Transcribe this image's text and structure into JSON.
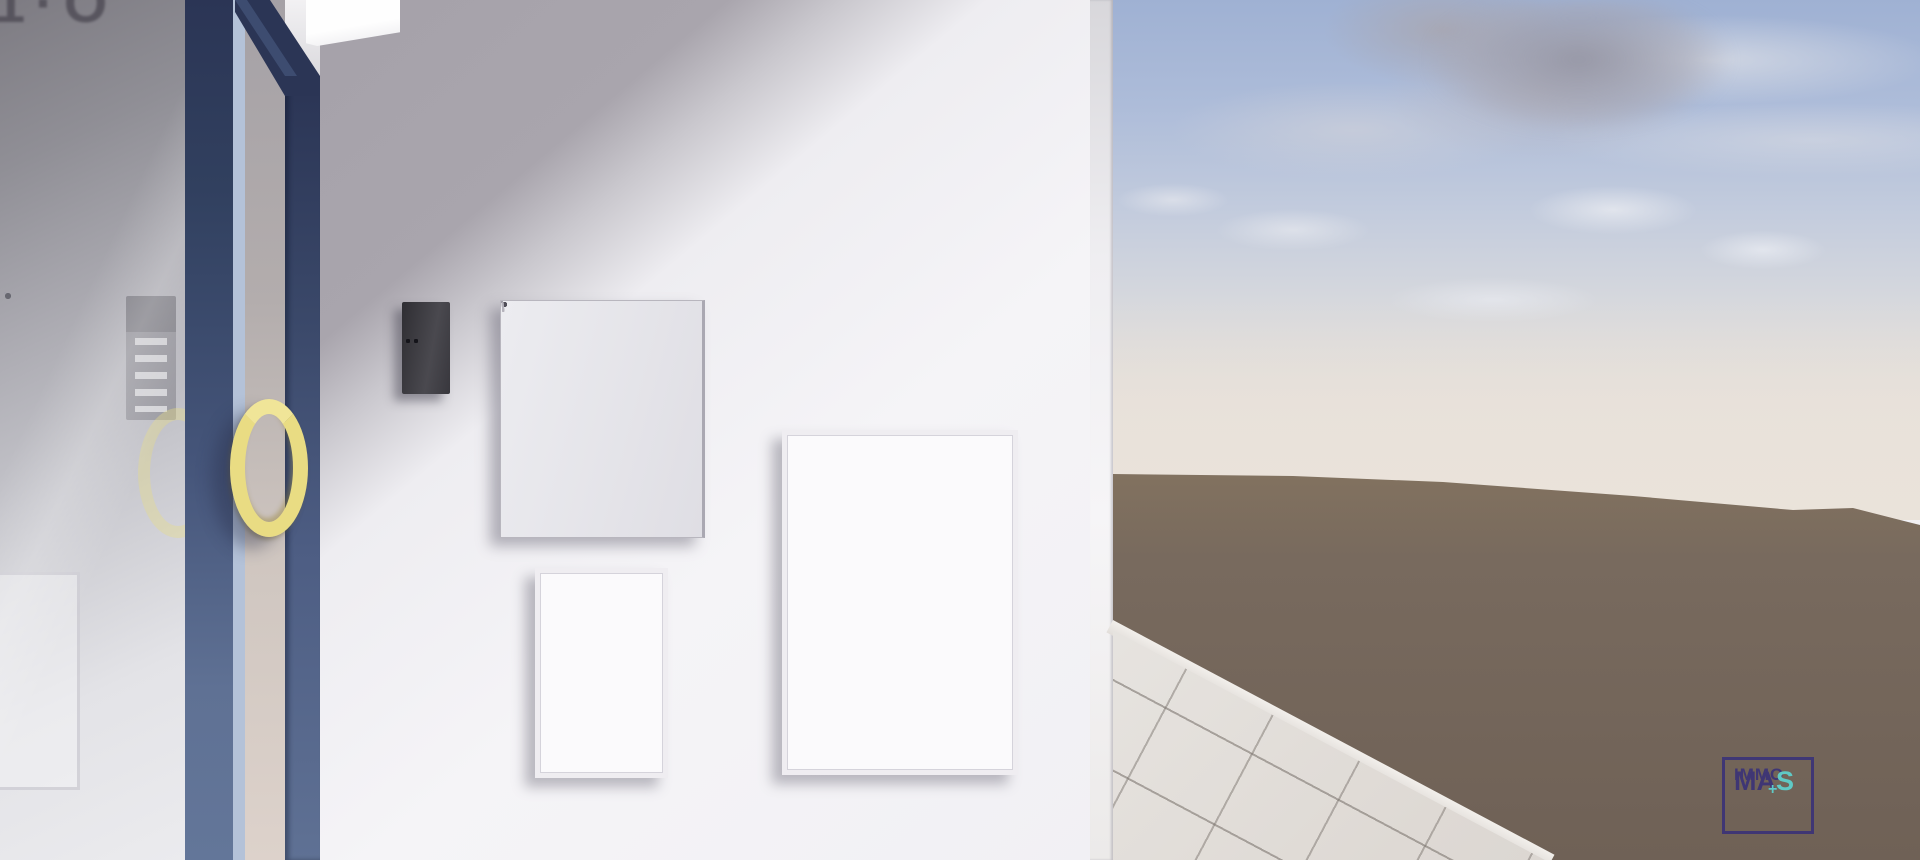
{
  "scene": {
    "glass_sign_partial_text": "1·O"
  },
  "logo": {
    "line1": "IMMO",
    "line2_prefix": "MA",
    "plus": "+",
    "line2_suffix": "S"
  },
  "mailboxes": {
    "columns": 2,
    "rows": 5
  },
  "intercom": {
    "label_slots": 5
  },
  "reflection": {
    "mailbox_rows": 5
  },
  "colors": {
    "frame-navy": "#2b3555",
    "frame-steel": "#5f7194",
    "frame-edge-light": "#b4c2d8",
    "handle-yellow": "#e9dc83",
    "wall-shadow": "#a5a1a9",
    "wall-light": "#f5f4f7",
    "sky-top": "#9fb1d3",
    "haze": "#eae3da",
    "ground-brown": "#786a5e",
    "tile-light": "#ded9d4",
    "logo-purple": "#3b3377",
    "logo-teal": "#5ed2cf"
  }
}
